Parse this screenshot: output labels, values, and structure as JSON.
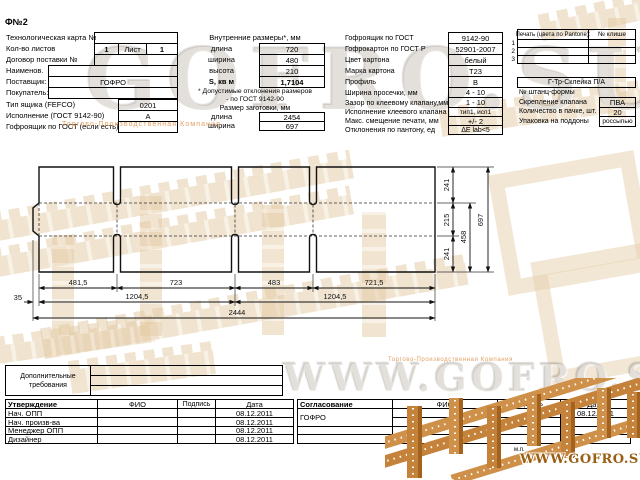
{
  "title": "Ф№2",
  "left": {
    "rows": [
      {
        "label": "Технологическая карта №",
        "value": ""
      },
      {
        "label": "Кол-во листов",
        "value1": "1",
        "mid": "Лист",
        "value2": "1"
      },
      {
        "label": "Договор поставки №",
        "value": ""
      },
      {
        "label": "Наименов.",
        "value": ""
      },
      {
        "label": "Поставщик:",
        "value": "ГОФРО"
      },
      {
        "label": "Покупатель:",
        "value": ""
      }
    ],
    "box_rows": [
      {
        "label": "Тип ящика (FEFCO)",
        "value": "0201"
      },
      {
        "label": "Исполнение (ГОСТ 9142-90)",
        "value": "А"
      },
      {
        "label": "Гофроящик по ГОСТ (если есть)",
        "value": ""
      }
    ]
  },
  "inner": {
    "header": "Внутренние размеры*, мм",
    "rows": [
      {
        "label": "длина",
        "value": "720"
      },
      {
        "label": "ширина",
        "value": "480"
      },
      {
        "label": "высота",
        "value": "210"
      },
      {
        "label": "S, кв м",
        "value": "1,7104"
      }
    ],
    "note1": "* Допустимые отклонения размеров",
    "note2": "- по ГОСТ 9142-90",
    "blank_header": "Размер заготовки, мм",
    "blank_rows": [
      {
        "label": "длина",
        "value": "2454"
      },
      {
        "label": "ширина",
        "value": "697"
      }
    ]
  },
  "spec": {
    "rows": [
      {
        "label": "Гофроящик по ГОСТ",
        "value": "9142-90"
      },
      {
        "label": "Гофрокартон по ГОСТ Р",
        "value": "52901-2007"
      },
      {
        "label": "Цвет картона",
        "value": "белый"
      },
      {
        "label": "Марка картона",
        "value": "Т23"
      },
      {
        "label": "Профиль",
        "value": "В"
      },
      {
        "label": "Ширина просечки, мм",
        "value": "4 - 10"
      },
      {
        "label": "Зазор по клеевому клапану,мм",
        "value": "1 - 10"
      },
      {
        "label": "Исполнение клеевого клапана",
        "value": "тип1, исп1"
      },
      {
        "label": "Макс. смещение печати, мм",
        "value": "+/- 2"
      },
      {
        "label": "Отклонения по пантону, ед",
        "value": "ΔЕ lab<5"
      }
    ]
  },
  "print": {
    "header_left": "Печать (цвета по Pantone):",
    "header_right": "№ клише",
    "row_numbers": [
      "1",
      "2",
      "3"
    ]
  },
  "gluing": {
    "header": "Г-Тр-Склейка П/А",
    "rows": [
      {
        "label": "№ штанц-формы",
        "value": ""
      },
      {
        "label": "Скрепление клапана",
        "value": "ПВА"
      },
      {
        "label": "Количество в пачке, шт.",
        "value": "20"
      },
      {
        "label": "Упаковка на поддоны",
        "value": "россыпью"
      }
    ]
  },
  "drawing": {
    "panel_widths": [
      "481,5",
      "723",
      "483",
      "721,5"
    ],
    "glue_flap": "35",
    "half_totals": [
      "1204,5",
      "1204,5"
    ],
    "total_width": "2444",
    "heights": [
      "241",
      "215",
      "241"
    ],
    "body_height": "458",
    "total_height": "697"
  },
  "additional": {
    "line1": "Дополнительные",
    "line2": "требования"
  },
  "approval": {
    "headers": [
      "Утверждение",
      "ФИО",
      "Подпись",
      "Дата"
    ],
    "rows": [
      {
        "role": "Нач. ОПП",
        "fio": "",
        "sign": "",
        "date": "08.12.2011"
      },
      {
        "role": "Нач. произв-ва",
        "fio": "",
        "sign": "",
        "date": "08.12.2011"
      },
      {
        "role": "Менеджер ОПП",
        "fio": "",
        "sign": "",
        "date": "08.12.2011"
      },
      {
        "role": "Дизайнер",
        "fio": "",
        "sign": "",
        "date": "08.12.2011"
      }
    ]
  },
  "agreement": {
    "headers": [
      "Согласование",
      "ФИО",
      "Подпись",
      "Дата"
    ],
    "org": "ГОФРО",
    "date": "08.12.2011"
  },
  "stamp": "м.п.",
  "watermarks": {
    "ghost_top": "GOFRO.SU",
    "ghost_mid": "WWW.GOFRO.SU",
    "company": "Торгово-Производственная Компания",
    "company2": "Торгово-Производственная Компания",
    "url": "WWW.GOFRO.SU"
  },
  "colors": {
    "accent_orange": "#de8f46",
    "plank": "#cf9049",
    "plank_dark": "#a3631f",
    "ghost_gray": "#b2aa9b",
    "cardboard": "#e3c9a2"
  }
}
